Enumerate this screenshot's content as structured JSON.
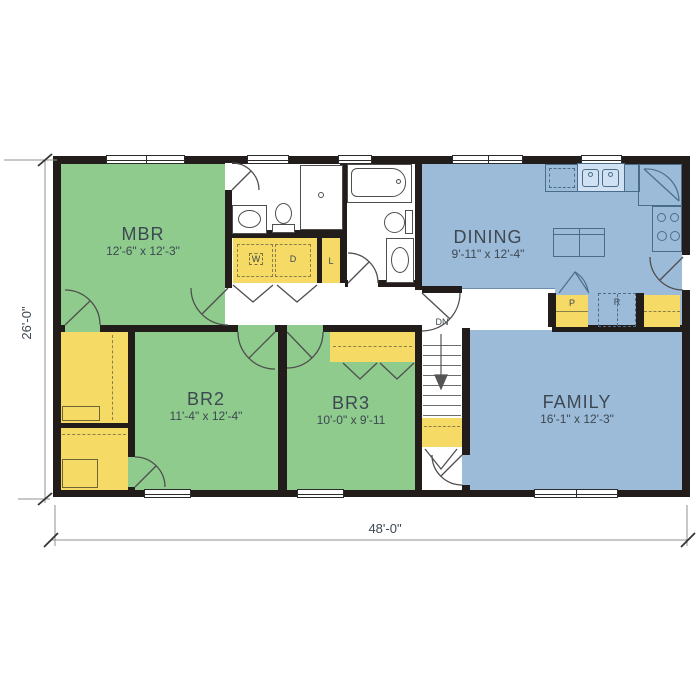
{
  "plan": {
    "title": "single-story ranch floor plan",
    "rooms": [
      {
        "id": "mbr",
        "name": "MBR",
        "dims": "12'-6\" x 12'-3\""
      },
      {
        "id": "dining",
        "name": "DINING",
        "dims": "9'-11\" x 12'-4\""
      },
      {
        "id": "br2",
        "name": "BR2",
        "dims": "11'-4\" x 12'-4\""
      },
      {
        "id": "br3",
        "name": "BR3",
        "dims": "10'-0\" x 9'-11"
      },
      {
        "id": "family",
        "name": "FAMILY",
        "dims": "16'-1\" x 12'-3\""
      }
    ],
    "fixture_labels": {
      "washer": "W",
      "dryer": "D",
      "linen": "L",
      "pantry": "P",
      "refrigerator": "R",
      "stairs_down": "DN"
    },
    "dimensions": {
      "overall_width": "48'-0\"",
      "overall_depth": "26'-0\""
    },
    "colors": {
      "bedroom_floor": "#8ecb8c",
      "living_floor": "#9cbbd8",
      "closet_floor": "#f5da66",
      "wall": "#221d1a",
      "kitchen_line": "#4a6e8a",
      "text": "#3d4852"
    }
  }
}
